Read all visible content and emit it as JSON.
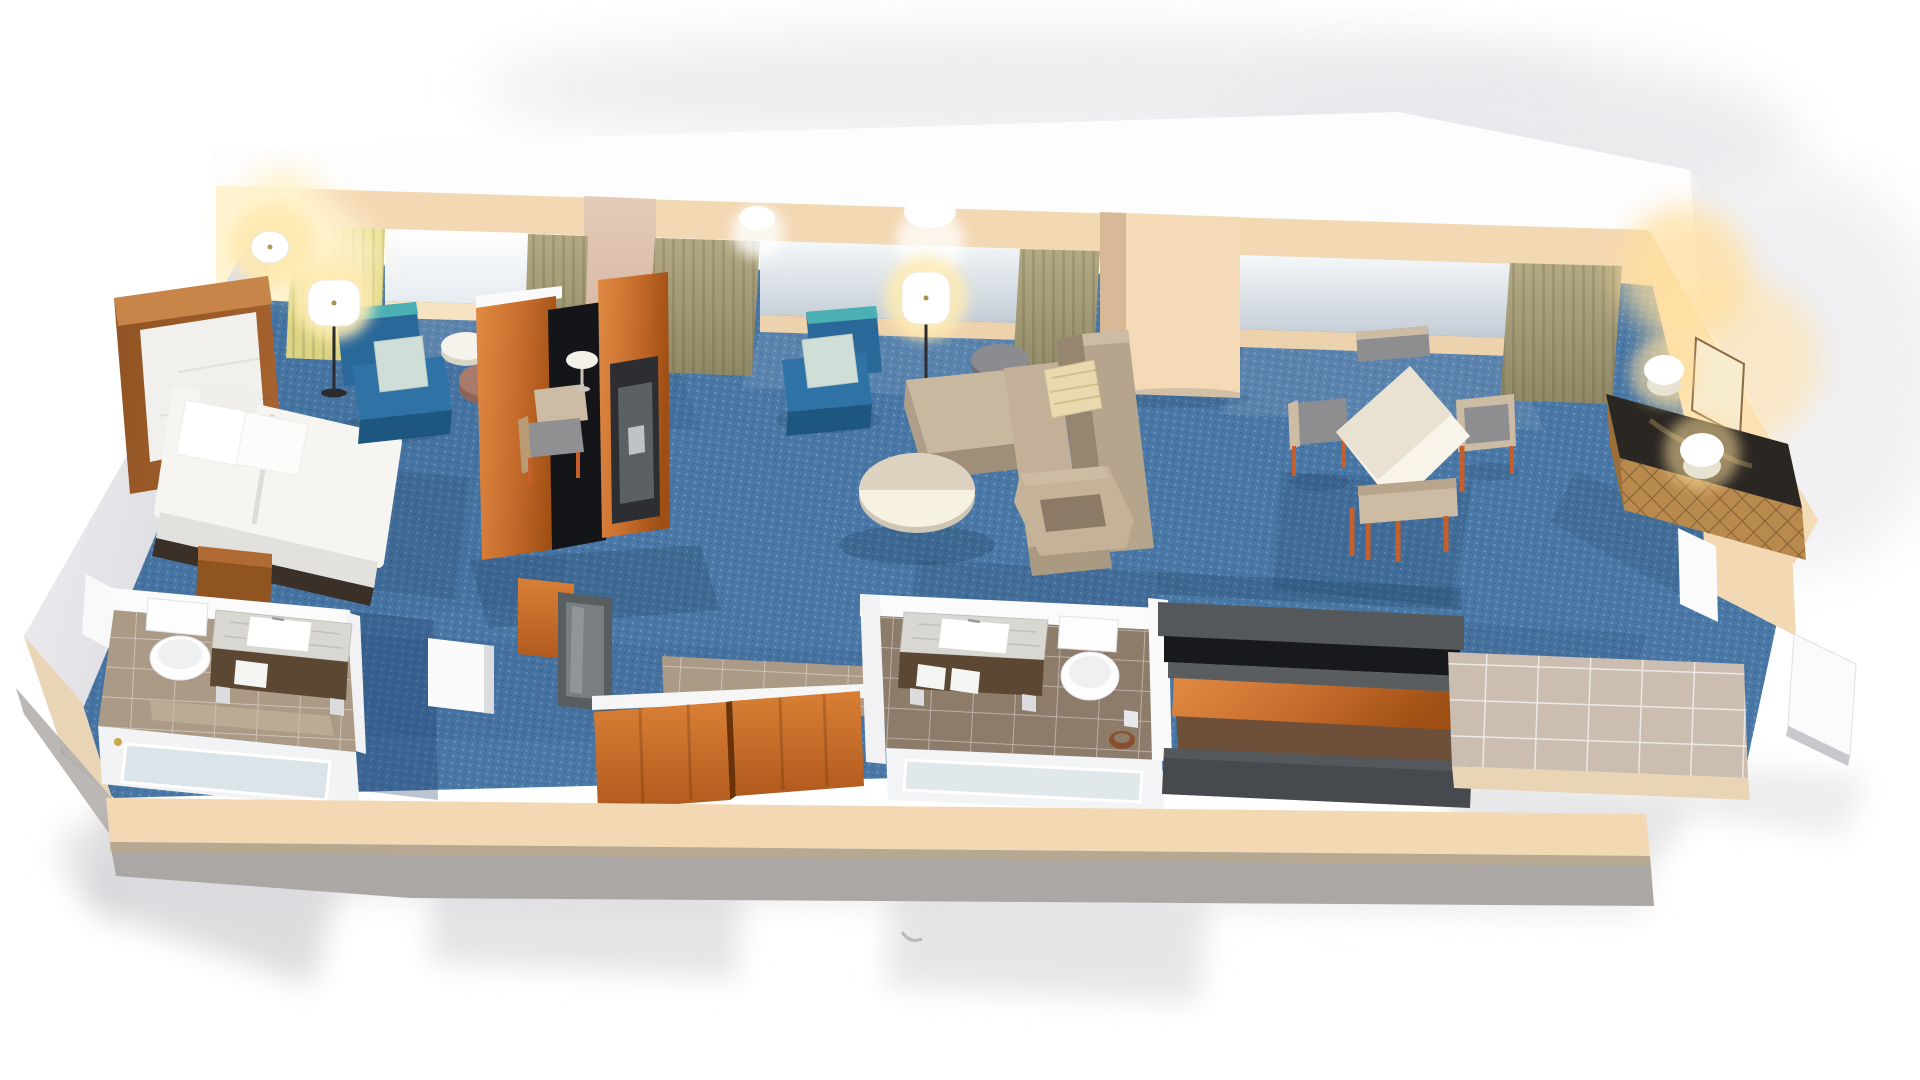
{
  "scene": {
    "title": "3D isometric cutaway rendering of a hotel two-room suite floor plan",
    "view": "axonometric top-down cutaway, no visible text",
    "canvas": {
      "width": 1920,
      "height": 1080
    }
  },
  "palette": {
    "carpet": "#4a78a6",
    "wallCream": "#f3d8b4",
    "wallMauve": "#e5cab8",
    "fixtureWhite": "#fdfdfd",
    "marble": "#d9d7d2",
    "woodDark": "#5c4733",
    "woodBright": "#c96f2e",
    "headboard": "#a5622f",
    "tileTan": "#ab9a85",
    "tileBrown": "#8d7c69",
    "tileEntry": "#cbbdb0",
    "tileDarkBrown": "#6e4f3a",
    "counterGray": "#55585b",
    "counterBlack": "#17191c",
    "benchGray": "#46494d",
    "chairBlue": "#2a6899",
    "chairTeal": "#4ab0b4",
    "pillowLight": "#cfdfd8",
    "sofaTan": "#c0ae96",
    "pillowTan": "#ead9ae",
    "ottoman": "#a87b6d",
    "sideGray": "#8b8b90",
    "tanSeat": "#cdbca4",
    "grayBack": "#8e8e90",
    "orangeLeg": "#c55f2d",
    "deskBlack": "#2a2723",
    "glowWarm": "#ffdf9e",
    "curtain": "#b3aa84",
    "curtainLit": "#d9d383",
    "glass": "#dfe6ec"
  },
  "rooms": [
    {
      "name": "bedroom",
      "furniture": [
        "king bed with white bedding",
        "wood headboard",
        "nightstand",
        "corner table lamp",
        "blue lounge chair with seafoam pillow",
        "round white side table",
        "round ottoman",
        "floor lamp",
        "desk chair",
        "two-sided wood TV console"
      ]
    },
    {
      "name": "master bathroom",
      "furniture": [
        "marble vanity with vessel sink",
        "toilet",
        "bathtub with shower fixture"
      ]
    },
    {
      "name": "living room",
      "furniture": [
        "blue armchair with pillow",
        "floor lamp",
        "round gray side table",
        "L-shaped tan sectional sofa",
        "patterned throw pillow",
        "round white coffee table",
        "tan lounge armchair"
      ]
    },
    {
      "name": "second bathroom",
      "furniture": [
        "marble vanity with vessel sink",
        "toilet",
        "bathtub",
        "waste basket"
      ]
    },
    {
      "name": "closet hallway",
      "furniture": [
        "two sliding wood closet doors",
        "full-length mirror",
        "tile hallway"
      ]
    },
    {
      "name": "kitchenette bar",
      "furniture": [
        "bar counter with dark top and wood base",
        "low dark bench counter"
      ]
    },
    {
      "name": "dining area",
      "furniture": [
        "square white dining table",
        "four chairs with orange legs"
      ]
    },
    {
      "name": "entry media wall",
      "furniture": [
        "taupe entry tile",
        "open white entry door",
        "quilted-front media console with dark top",
        "two white table lamps",
        "leaning mirror"
      ]
    }
  ],
  "structure": {
    "flooring": [
      "blue patterned carpet",
      "tan bathroom tile",
      "brown bathroom tile",
      "taupe entry tile"
    ],
    "walls": "white-topped cream walls, cutaway height",
    "windows": [
      "bedroom window",
      "living room window",
      "dining window"
    ],
    "curtains": "olive drapes, left pair lamp-lit yellow"
  }
}
